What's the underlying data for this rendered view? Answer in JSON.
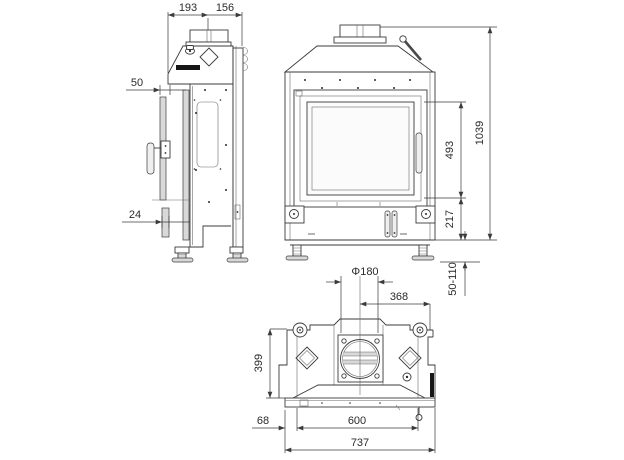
{
  "drawing": {
    "type": "technical-drawing",
    "subject": "fireplace-insert-three-view-dimension-drawing",
    "background": "#ffffff",
    "line_color": "#3b3b3b",
    "views": {
      "side": {
        "dims": {
          "depth_front": "193",
          "depth_rear": "156",
          "glass_offset": "50",
          "bottom_offset": "24"
        }
      },
      "front": {
        "dims": {
          "total_height": "1039",
          "glass_height": "493",
          "base_height": "217",
          "feet_range": "50-110"
        }
      },
      "top": {
        "dims": {
          "flue_diameter": "Φ180",
          "flue_center_offset": "368",
          "depth": "399",
          "frame_side_offset": "68",
          "body_width": "600",
          "frame_width": "737"
        }
      }
    }
  }
}
